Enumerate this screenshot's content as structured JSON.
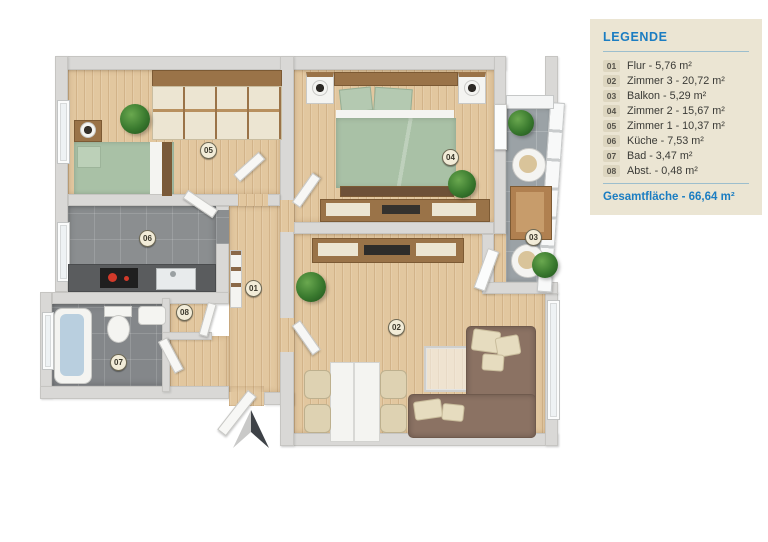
{
  "legend": {
    "title": "LEGENDE",
    "items": [
      {
        "num": "01",
        "text": "Flur - 5,76 m²"
      },
      {
        "num": "02",
        "text": "Zimmer 3 - 20,72 m²"
      },
      {
        "num": "03",
        "text": "Balkon - 5,29 m²"
      },
      {
        "num": "04",
        "text": "Zimmer 2 - 15,67 m²"
      },
      {
        "num": "05",
        "text": "Zimmer 1 - 10,37 m²"
      },
      {
        "num": "06",
        "text": "Küche - 7,53 m²"
      },
      {
        "num": "07",
        "text": "Bad - 3,47 m²"
      },
      {
        "num": "08",
        "text": "Abst. - 0,48 m²"
      }
    ],
    "total": "Gesamtfläche - 66,64 m²"
  },
  "plan": {
    "room_badges": [
      {
        "num": "01",
        "name": "Flur"
      },
      {
        "num": "02",
        "name": "Zimmer 3"
      },
      {
        "num": "03",
        "name": "Balkon"
      },
      {
        "num": "04",
        "name": "Zimmer 2"
      },
      {
        "num": "05",
        "name": "Zimmer 1"
      },
      {
        "num": "06",
        "name": "Küche"
      },
      {
        "num": "07",
        "name": "Bad"
      },
      {
        "num": "08",
        "name": "Abst."
      }
    ],
    "colors": {
      "wood_floor": "#e2c79f",
      "tile_floor": "#8b8e90",
      "balcony_floor": "#9ba2a6",
      "wall": "#d9d8d6",
      "bedding_green": "#a9c1a6",
      "sofa_brown": "#8b7263",
      "legend_bg": "#ebe5d3",
      "legend_accent": "#1b7dc2"
    }
  }
}
